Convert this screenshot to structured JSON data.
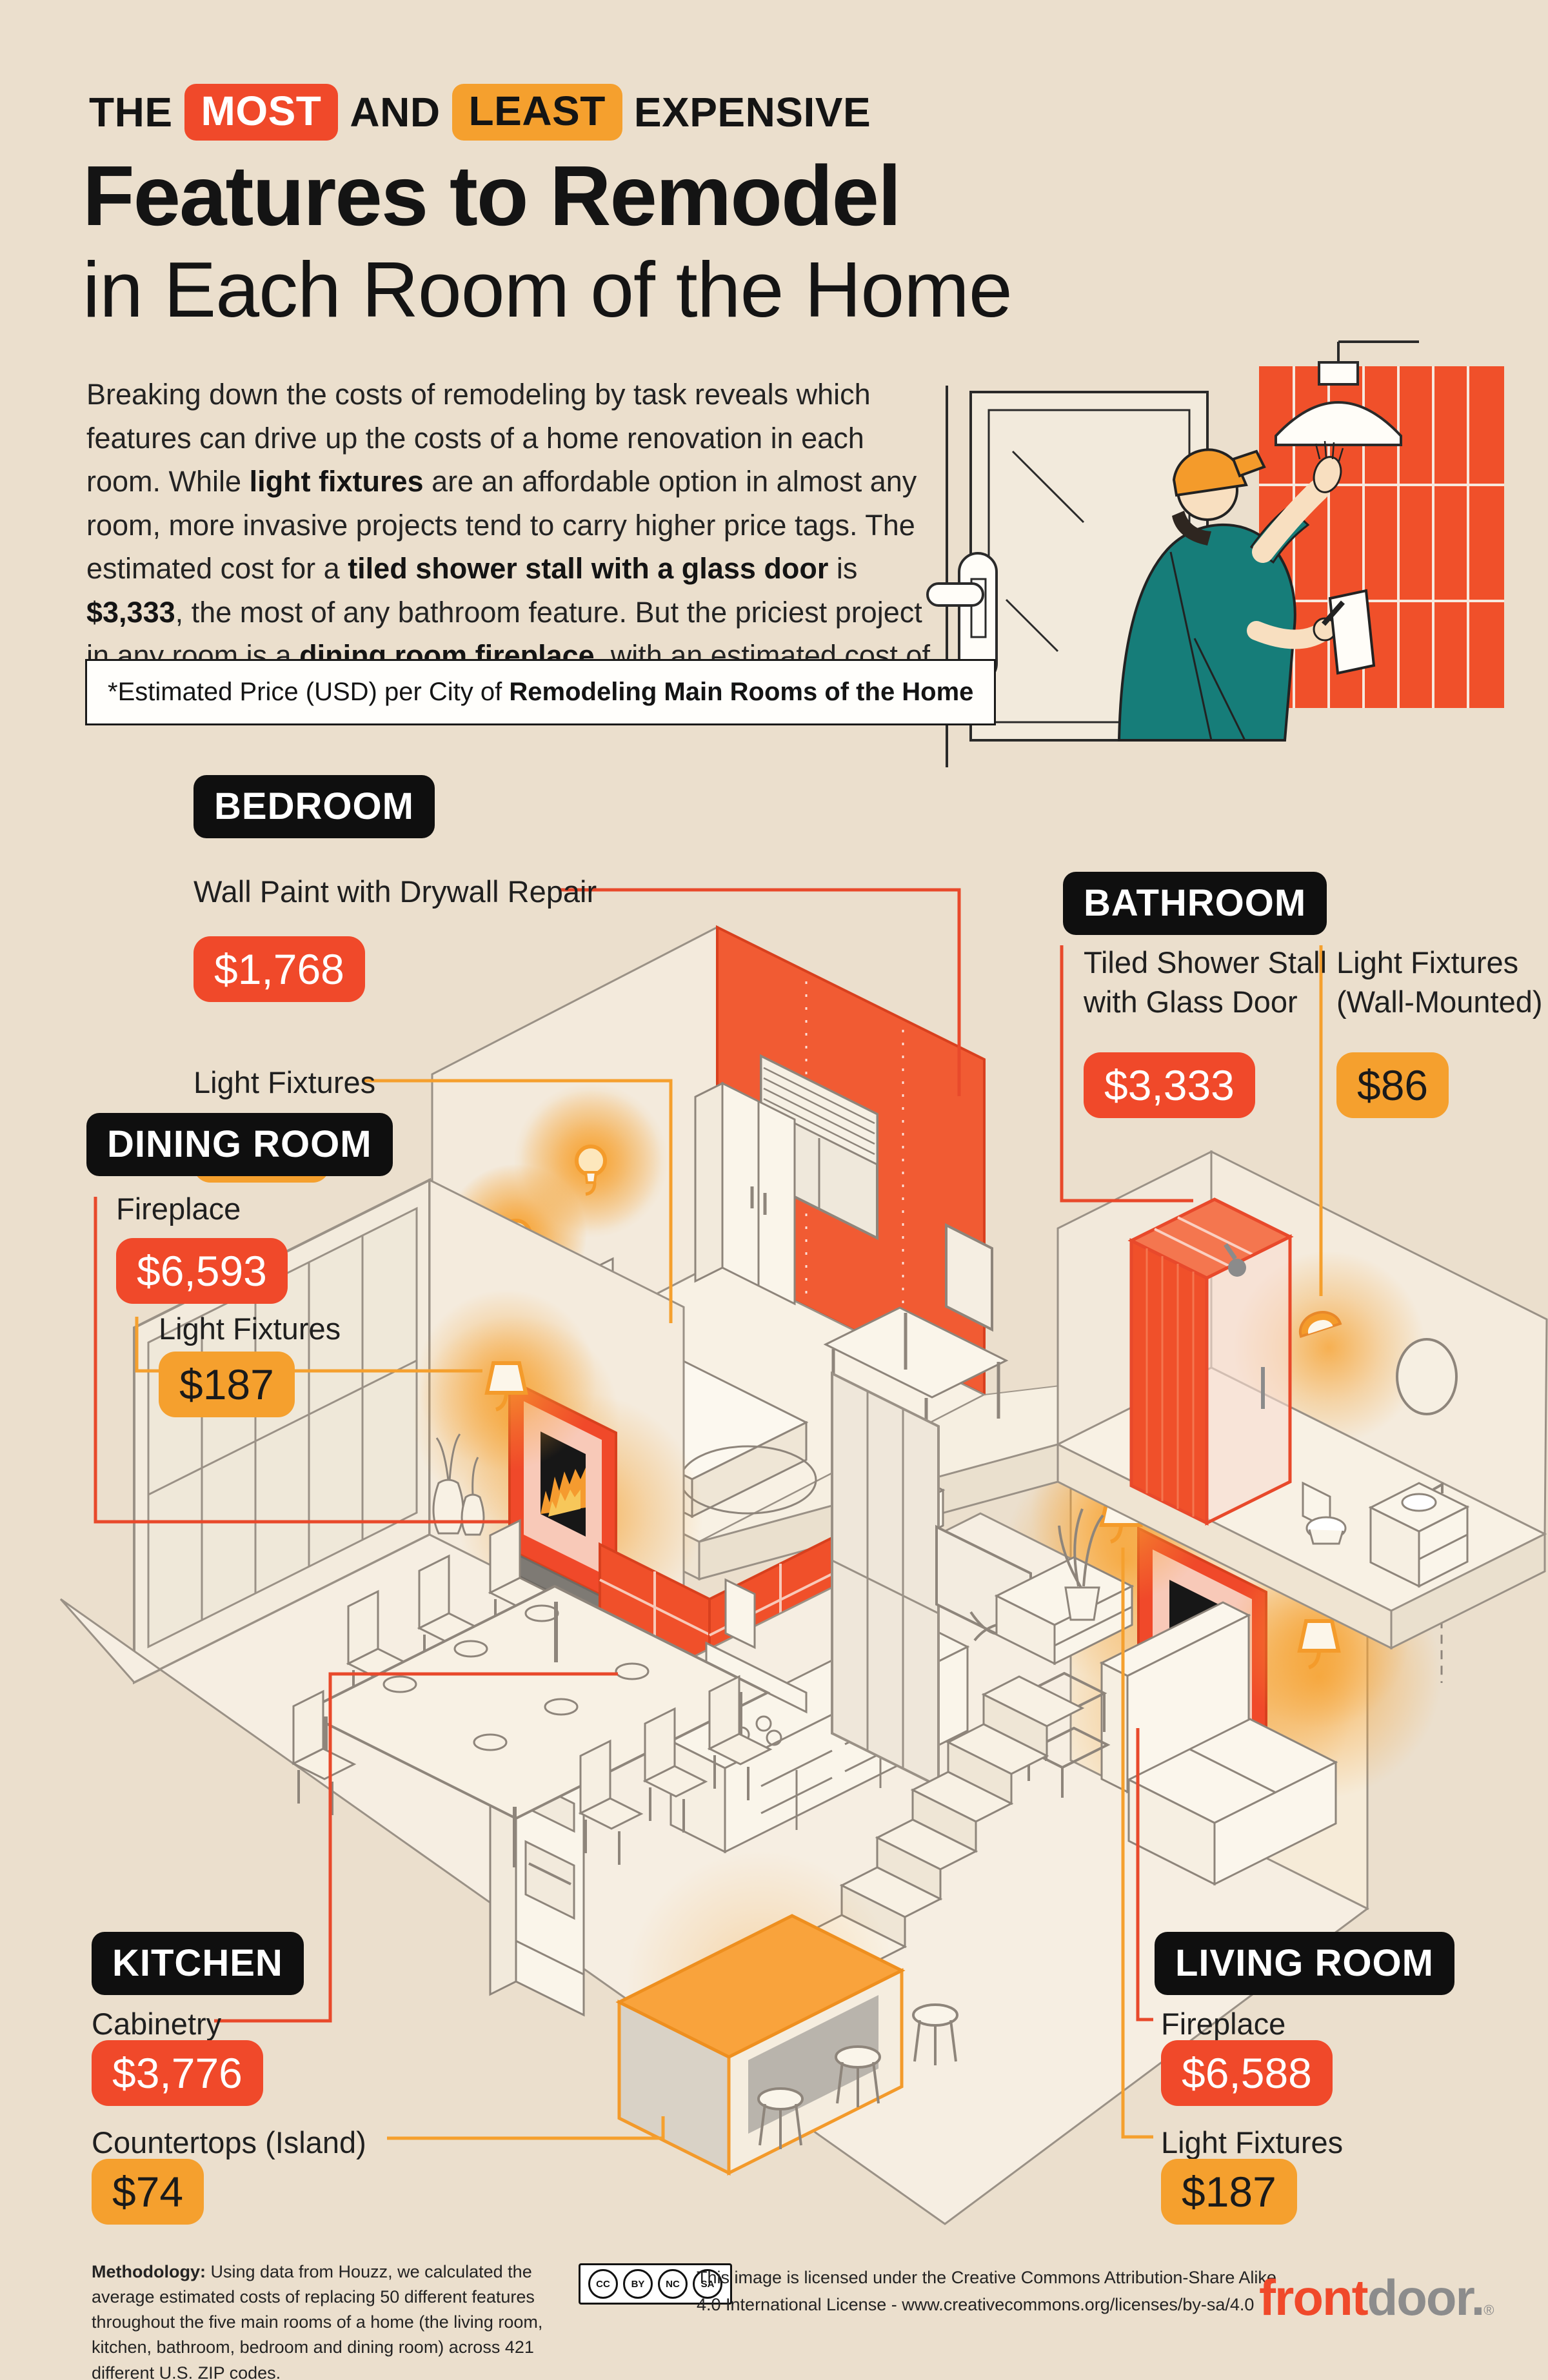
{
  "header": {
    "kicker": {
      "pre": "THE",
      "most": "MOST",
      "and": "AND",
      "least": "LEAST",
      "post": "EXPENSIVE"
    },
    "title": "Features to Remodel",
    "subtitle": "in Each Room of the Home",
    "intro": {
      "s1": "Breaking down the costs of remodeling by task reveals which features can drive up the costs of a home renovation in each room. While ",
      "b1": "light fixtures",
      "s2": " are an affordable option in almost any room, more invasive projects tend to carry higher price tags. The estimated cost for a ",
      "b2": "tiled shower stall with a glass door",
      "s3": " is ",
      "b3": "$3,333",
      "s4": ", the most of any bathroom feature. But the priciest project in any room is a ",
      "b4": "dining room fireplace",
      "s5": ", with an estimated cost of ",
      "b5": "$6,593",
      "s6": "."
    },
    "note": {
      "pre": "*Estimated Price (USD) per City of ",
      "bold": "Remodeling Main Rooms of the Home"
    }
  },
  "rooms": [
    {
      "label": "BEDROOM",
      "items": [
        {
          "name": "Wall Paint with Drywall Repair",
          "price": "$1,768"
        },
        {
          "name": "Light Fixtures",
          "price": "$187"
        }
      ]
    },
    {
      "label": "BATHROOM",
      "items": [
        {
          "name": "Tiled Shower Stall with Glass Door",
          "price": "$3,333"
        },
        {
          "name": "Light Fixtures (Wall-Mounted)",
          "price": "$86"
        }
      ]
    },
    {
      "label": "DINING ROOM",
      "items": [
        {
          "name": "Fireplace",
          "price": "$6,593"
        },
        {
          "name": "Light Fixtures",
          "price": "$187"
        }
      ]
    },
    {
      "label": "KITCHEN",
      "items": [
        {
          "name": "Cabinetry",
          "price": "$3,776"
        },
        {
          "name": "Countertops (Island)",
          "price": "$74"
        }
      ]
    },
    {
      "label": "LIVING ROOM",
      "items": [
        {
          "name": "Fireplace",
          "price": "$6,588"
        },
        {
          "name": "Light Fixtures",
          "price": "$187"
        }
      ]
    }
  ],
  "footer": {
    "methodology_label": "Methodology:",
    "methodology_text": " Using data from Houzz, we calculated the average estimated costs of replacing 50 different features throughout the five main rooms of a home (the living room, kitchen, bathroom, bedroom and dining room) across 421 different U.S. ZIP codes.",
    "license_line1": "This image is licensed under the Creative Commons Attribution-Share Alike",
    "license_line2": "4.0 International License - www.creativecommons.org/licenses/by-sa/4.0",
    "cc": [
      "CC",
      "BY",
      "NC",
      "SA"
    ],
    "logo": {
      "front": "front",
      "door": "door",
      "dot": ".",
      "mark": "®"
    }
  },
  "colors": {
    "accent_red": "#F0492A",
    "accent_orange": "#F5A02E",
    "background": "#EBDFCD",
    "badge_black": "#0F0F0F"
  }
}
